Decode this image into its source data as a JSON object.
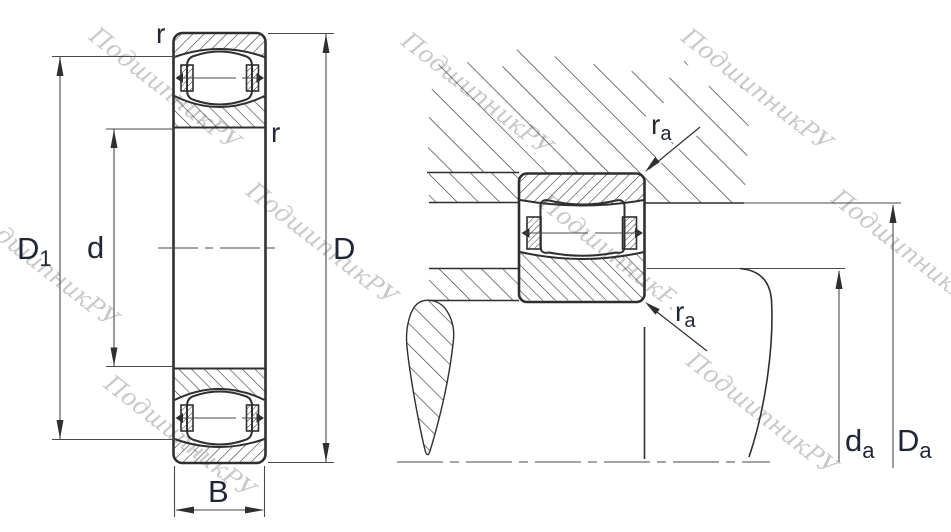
{
  "colors": {
    "background": "#ffffff",
    "line": "#2f2f2f",
    "thin_line": "#4a4a4a",
    "label": "#202634",
    "watermark": "#c9c9c9"
  },
  "watermark": {
    "text": "ПодшипникРУ"
  },
  "left_view": {
    "description": "bearing cross-section",
    "labels": {
      "r_top": "r",
      "r_side": "r",
      "D1": {
        "base": "D",
        "sub": "1"
      },
      "d": "d",
      "D": "D",
      "B": "B"
    }
  },
  "right_view": {
    "description": "mounting arrangement",
    "labels": {
      "ra_top": {
        "base": "r",
        "sub": "a"
      },
      "ra_bottom": {
        "base": "r",
        "sub": "a"
      },
      "da": {
        "base": "d",
        "sub": "a"
      },
      "Da": {
        "base": "D",
        "sub": "a"
      }
    }
  }
}
